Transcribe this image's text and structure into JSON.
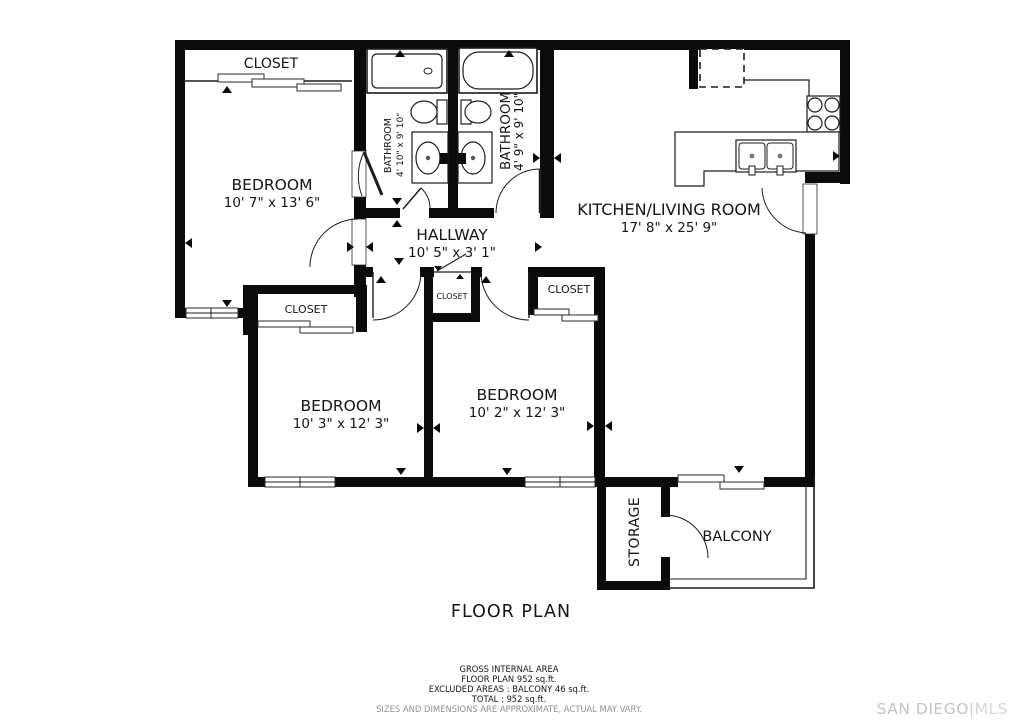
{
  "title": "FLOOR PLAN",
  "rooms": {
    "bedroom1": {
      "label": "BEDROOM",
      "dims": "10' 7\" x 13' 6\""
    },
    "bedroom2": {
      "label": "BEDROOM",
      "dims": "10' 3\" x 12' 3\""
    },
    "bedroom3": {
      "label": "BEDROOM",
      "dims": "10' 2\" x 12' 3\""
    },
    "kitchen_living": {
      "label": "KITCHEN/LIVING ROOM",
      "dims": "17' 8\" x 25' 9\""
    },
    "hallway": {
      "label": "HALLWAY",
      "dims": "10' 5\" x 3' 1\""
    },
    "bathroom1": {
      "label": "BATHROOM",
      "dims": "4' 10\" x 9' 10\""
    },
    "bathroom2": {
      "label": "BATHROOM",
      "dims": "4' 9\" x 9' 10\""
    },
    "closet_bedroom1": {
      "label": "CLOSET"
    },
    "closet_bedroom2": {
      "label": "CLOSET"
    },
    "closet_hallway": {
      "label": "CLOSET"
    },
    "closet_bedroom3": {
      "label": "CLOSET"
    },
    "storage": {
      "label": "STORAGE"
    },
    "balcony": {
      "label": "BALCONY"
    }
  },
  "footer": {
    "line1": "GROSS INTERNAL AREA",
    "line2": "FLOOR PLAN 952 sq.ft.",
    "line3": "EXCLUDED AREAS :  BALCONY 46 sq.ft.",
    "line4": "TOTAL :  952 sq.ft.",
    "disclaimer": "SIZES AND DIMENSIONS ARE APPROXIMATE, ACTUAL MAY VARY."
  },
  "watermark": {
    "brand": "SAN DIEGO",
    "divider": "|",
    "suffix": "MLS"
  },
  "colors": {
    "wall": "#0b0b0b",
    "line": "#1c1c1c",
    "text": "#151515",
    "muted": "#8f8f8f",
    "watermark_brand": "#c3c3c3",
    "watermark_suffix": "#d6d6d6"
  }
}
